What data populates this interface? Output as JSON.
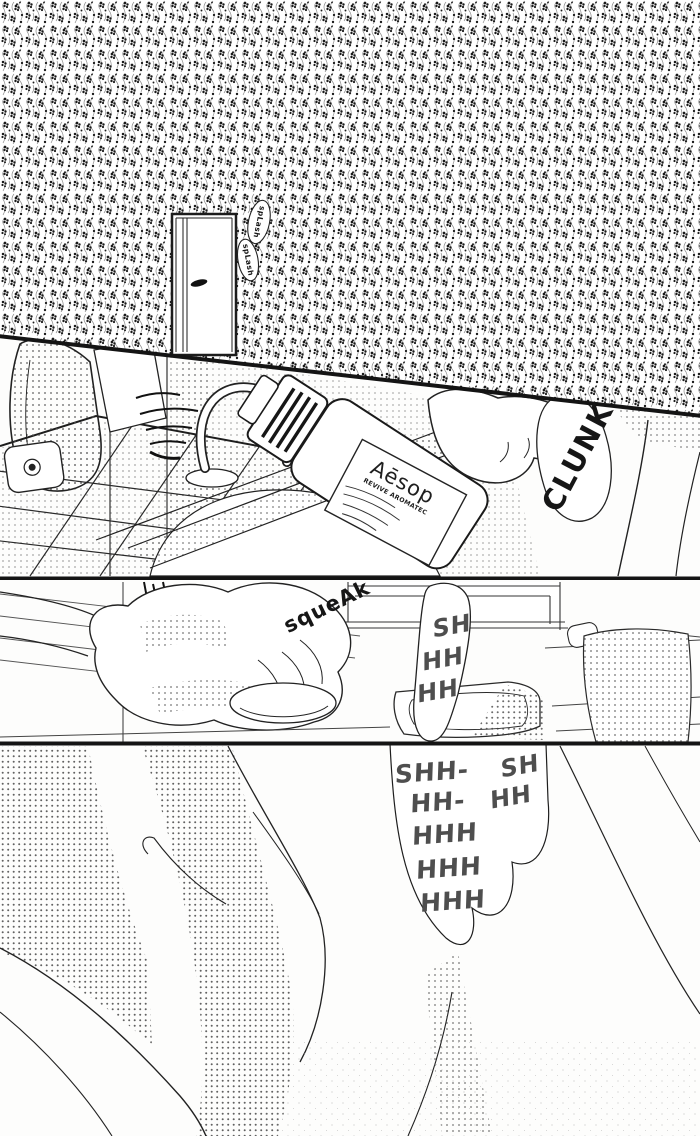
{
  "page": {
    "kind": "black-and-white manga page",
    "paper_color": "#fbfbf9",
    "ink_color": "#161616",
    "tone_text_color": "#4e4e4e"
  },
  "panel1": {
    "sfx_splash_top": "spLash",
    "sfx_splash_bottom": "spLash"
  },
  "panel2": {
    "sfx_clunk": "CLUNK",
    "bottle_brand": "Aēsop",
    "bottle_label_line": "REVIVE AROMATEC"
  },
  "panel3": {
    "sfx_squeak": "squeAk",
    "sfx_water": [
      "SH",
      "HH",
      "HH"
    ]
  },
  "panel4": {
    "sfx_water_main": [
      "SHH-",
      "HH-",
      "HHH",
      "HHH",
      "HHH"
    ],
    "sfx_water_side": [
      "SH",
      "HH"
    ]
  }
}
